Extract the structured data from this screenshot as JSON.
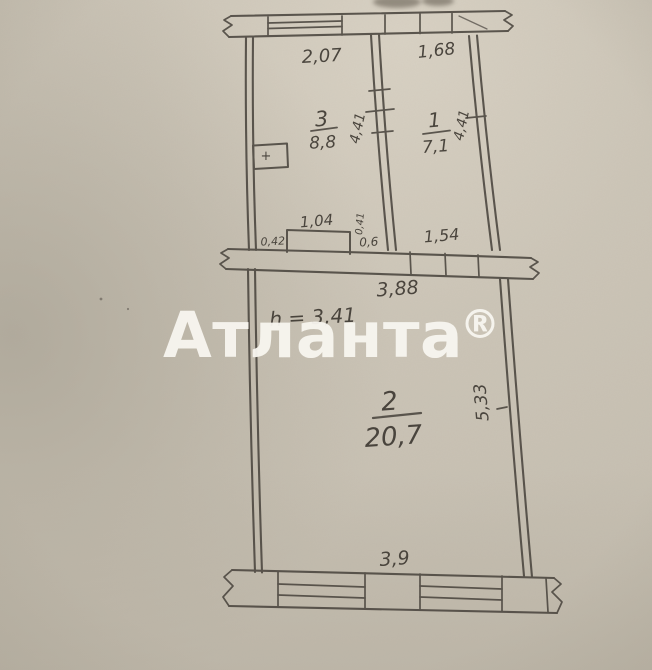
{
  "photo": {
    "agency_watermark": "Атланта",
    "registered_mark": "®"
  },
  "plan": {
    "ceiling_height": "h = 3,41",
    "vent_symbol": "+",
    "rooms": {
      "room3": {
        "number": "3",
        "area": "8,8",
        "width": "2,07",
        "depth": "4,41"
      },
      "room1": {
        "number": "1",
        "area": "7,1",
        "width": "1,68",
        "depth": "4,41"
      },
      "room2": {
        "number": "2",
        "area": "20,7",
        "width_top": "3,88",
        "depth": "5,33",
        "width_bottom": "3,9"
      }
    },
    "small_dims": {
      "ledge_width": "1,04",
      "wall_offset": "0,42",
      "niche_depth": "0,41",
      "niche_width": "0,6",
      "opening_width": "1,54"
    }
  },
  "colors": {
    "paper": "#c7c0b2",
    "ink": "#4a453e",
    "watermark": "#f8f6f0"
  }
}
